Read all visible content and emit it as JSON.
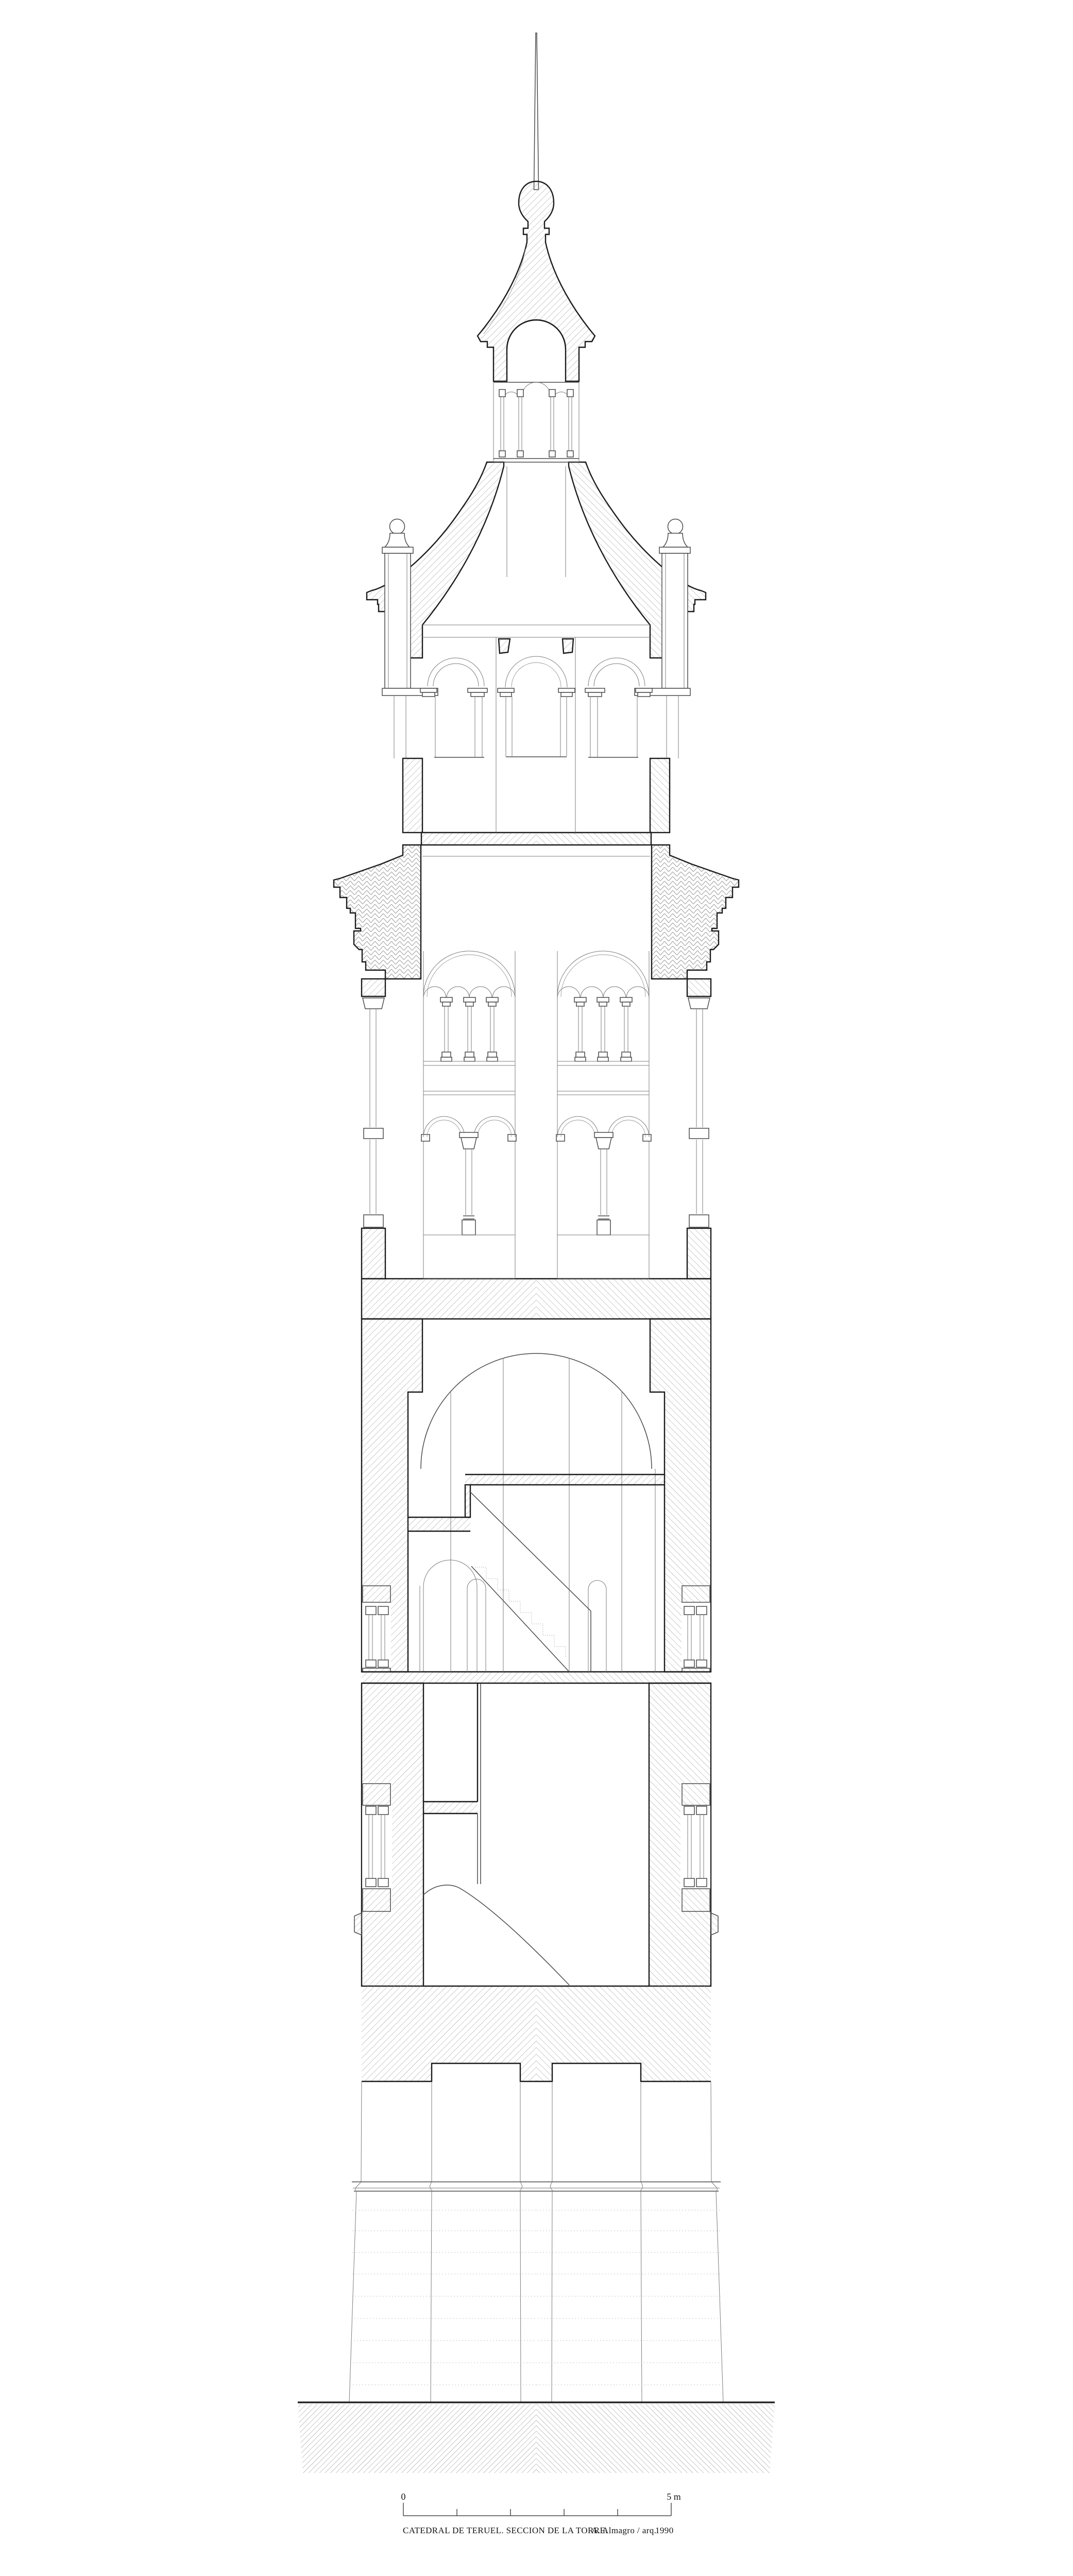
{
  "document": {
    "type": "architectural-section-drawing",
    "caption": {
      "title": "CATEDRAL DE TERUEL. SECCION DE LA TORRE.",
      "credit": "A. Almagro / arq.",
      "year": "1990"
    },
    "scale_bar": {
      "start_label": "0",
      "end_label": "5 m",
      "divisions": 5
    },
    "colors": {
      "ink": "#1c1c1c",
      "thin_line": "#7c7c7c",
      "hatch_line": "#9a9a9a",
      "background": "#ffffff"
    }
  }
}
